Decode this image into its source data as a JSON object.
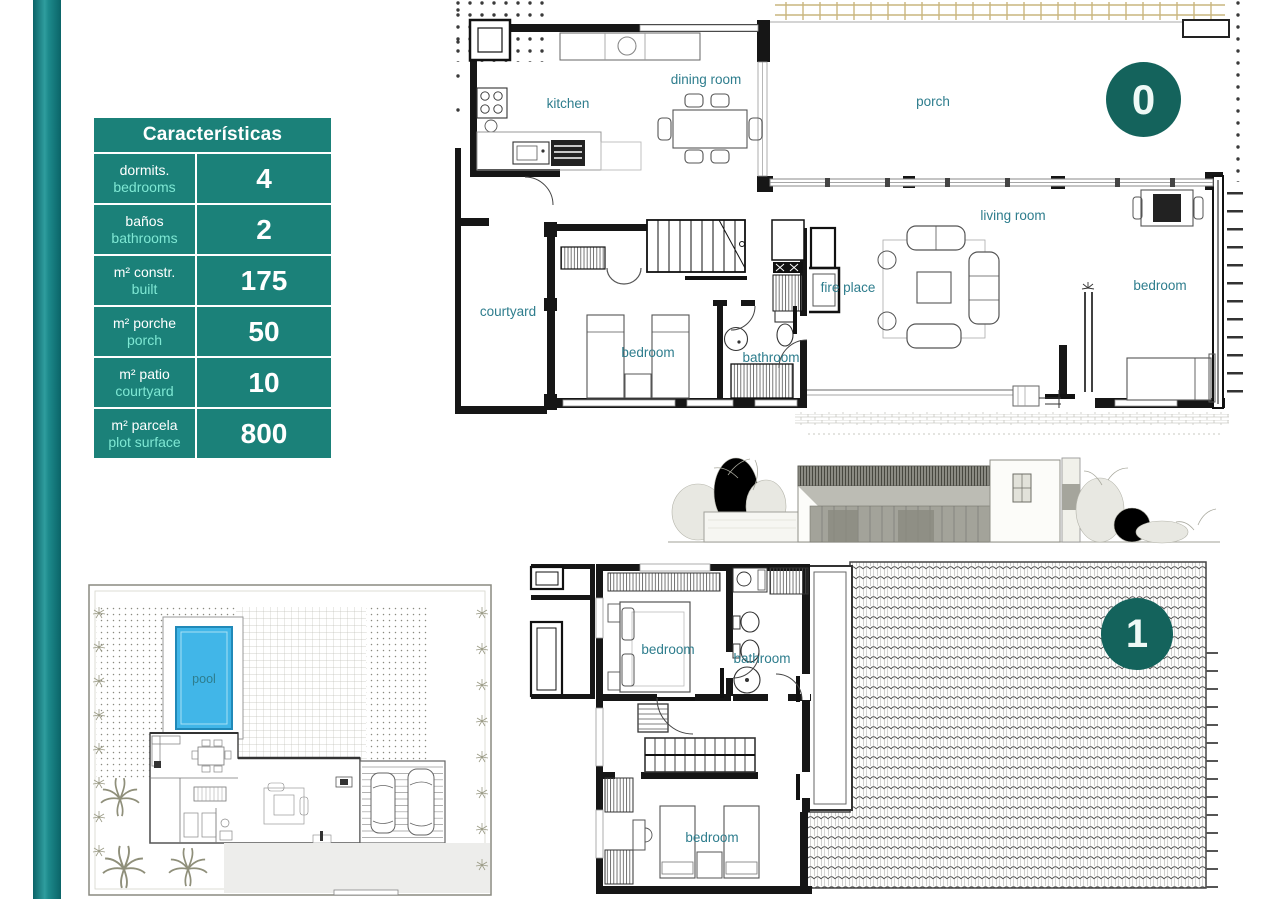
{
  "characteristics_table": {
    "title": "Características",
    "rows": [
      {
        "label_es": "dormits.",
        "label_en": "bedrooms",
        "value": "4"
      },
      {
        "label_es": "baños",
        "label_en": "bathrooms",
        "value": "2"
      },
      {
        "label_es": "m² constr.",
        "label_en": "built",
        "value": "175"
      },
      {
        "label_es": "m² porche",
        "label_en": "porch",
        "value": "50"
      },
      {
        "label_es": "m² patio",
        "label_en": "courtyard",
        "value": "10"
      },
      {
        "label_es": "m² parcela",
        "label_en": "plot surface",
        "value": "800"
      }
    ]
  },
  "floor0": {
    "badge": "0",
    "labels": {
      "kitchen": "kitchen",
      "dining_room": "dining room",
      "porch": "porch",
      "living_room": "living room",
      "fire_place": "fire place",
      "courtyard": "courtyard",
      "bedroom_main": "bedroom",
      "bathroom": "bathroom",
      "bedroom_right": "bedroom"
    }
  },
  "floor1": {
    "badge": "1",
    "labels": {
      "bedroom_top": "bedroom",
      "bathroom": "bathroom",
      "bedroom_bottom": "bedroom"
    }
  },
  "site_plan": {
    "labels": {
      "pool": "pool"
    }
  },
  "colors": {
    "teal": "#1b8179",
    "teal_dark": "#14635c",
    "accent_en_text": "#7fe8d4",
    "room_label": "#2e7d8d",
    "pool_blue": "#41b6e8",
    "pergola_tan": "#c9b57e"
  }
}
